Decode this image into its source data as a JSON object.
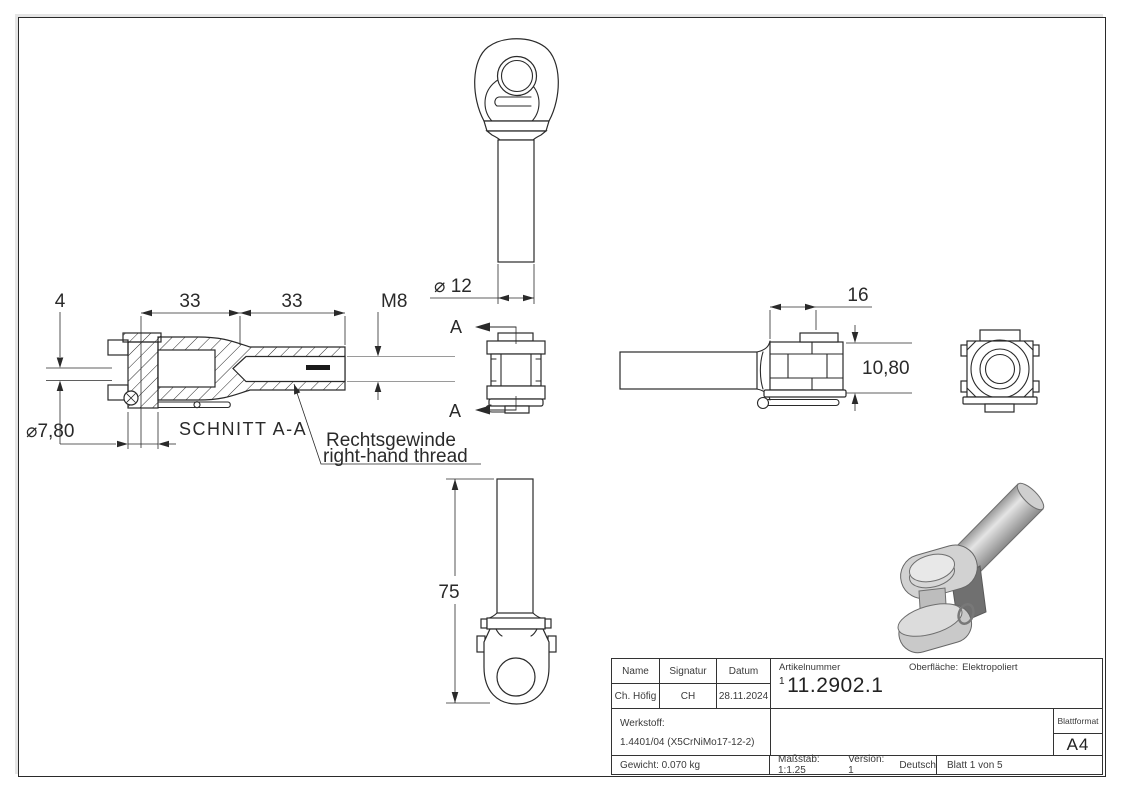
{
  "views": {
    "top": {
      "dia_label": "⌀ 12"
    },
    "section": {
      "title": "SCHNITT A-A",
      "dim_offset": "4",
      "dim_len1": "33",
      "dim_len2": "33",
      "dim_thread": "M8",
      "dim_pin_dia": "⌀7,80",
      "note_line1": "Rechtsgewinde",
      "note_line2": "right-hand thread"
    },
    "front": {
      "cut_label_top": "A",
      "cut_label_bottom": "A"
    },
    "side": {
      "dim_head_len": "16",
      "dim_head_height": "10,80"
    },
    "bottom": {
      "dim_length": "75"
    }
  },
  "title_block": {
    "name_label": "Name",
    "signature_label": "Signatur",
    "date_label": "Datum",
    "name_value": "Ch. Höfig",
    "signature_value": "CH",
    "date_value": "28.11.2024",
    "article_label": "Artikelnummer",
    "article_prefix": "1",
    "article_number": "11.2902.1",
    "surface_label": "Oberfläche:",
    "surface_value": "Elektropoliert",
    "material_label": "Werkstoff:",
    "material_value": "1.4401/04 (X5CrNiMo17-12-2)",
    "format_label": "Blattformat",
    "format_value": "A4",
    "weight": "Gewicht: 0.070 kg",
    "scale": "Maßstab: 1:1.25",
    "version": "Version: 1",
    "language": "Deutsch",
    "sheet": "Blatt 1 von 5"
  }
}
